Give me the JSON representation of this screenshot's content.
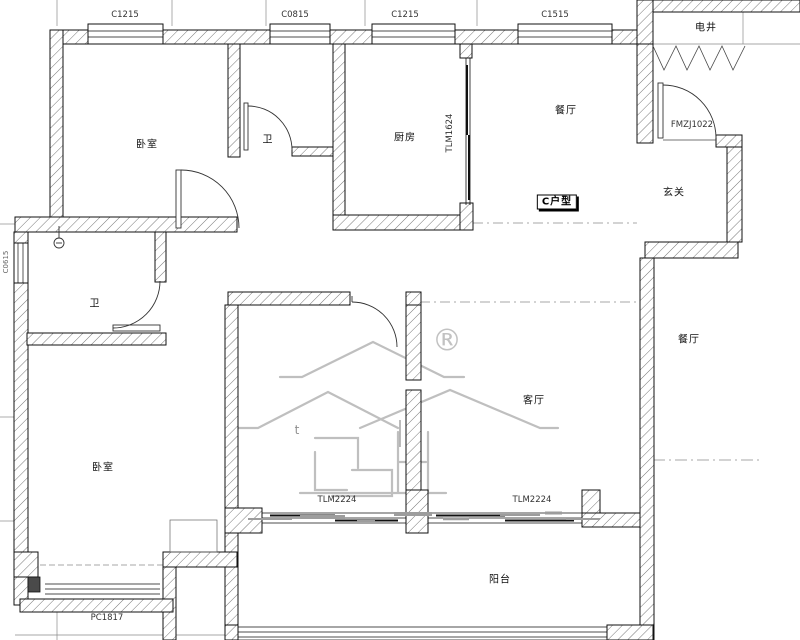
{
  "unit_badge": "C户型",
  "rooms": {
    "bedroom_top": "卧室",
    "bath_top": "卫",
    "kitchen": "厨房",
    "dining_top": "餐厅",
    "utility_shaft": "电井",
    "foyer": "玄关",
    "bath_lower": "卫",
    "bedroom_lower": "卧室",
    "living_room": "客厅",
    "dining_right": "餐厅",
    "balcony": "阳台"
  },
  "windows": {
    "top_1": "C1215",
    "top_2": "C0815",
    "top_3": "C1215",
    "top_4": "C1515",
    "left_small": "C0615",
    "bay_bottom": "PC1817"
  },
  "doors": {
    "entry": "FMZJ1022",
    "kitchen_sliding": "TLM1624",
    "balcony_sliding_left": "TLM2224",
    "balcony_sliding_right": "TLM2224"
  },
  "watermark": {
    "registered_symbol": "®",
    "small_mark": "t"
  },
  "colors": {
    "wall_line": "#1a1a1a",
    "hatch": "#777777",
    "grid": "#8a8a8a",
    "watermark": "#bfbfbf"
  }
}
